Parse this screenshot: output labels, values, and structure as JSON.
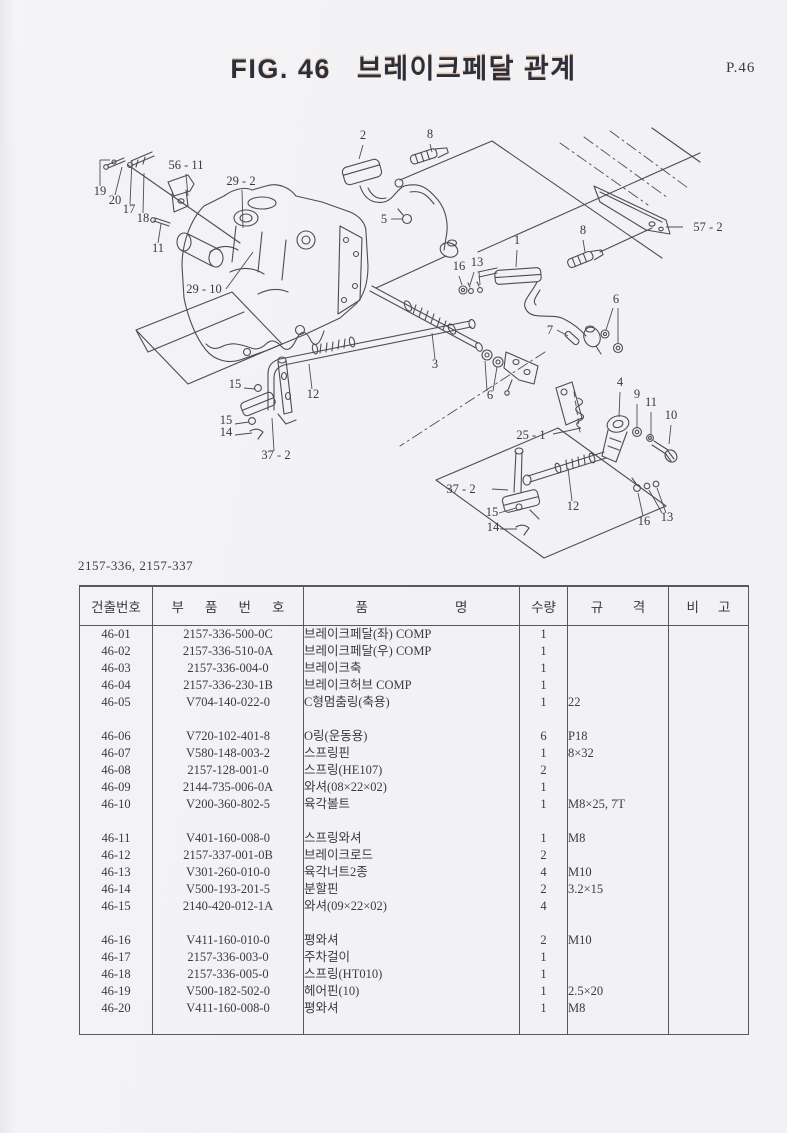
{
  "header": {
    "fig_label": "FIG. 46",
    "title": "브레이크페달 관계",
    "page_label": "P.46"
  },
  "models_label": "2157-336, 2157-337",
  "diagram": {
    "callouts": [
      {
        "label": "19",
        "x": 100,
        "y": 195,
        "leaders": [
          [
            100,
            186,
            100,
            160
          ],
          [
            100,
            160,
            110,
            160
          ]
        ]
      },
      {
        "label": "20",
        "x": 115,
        "y": 204,
        "leaders": [
          [
            115,
            195,
            122,
            167
          ]
        ]
      },
      {
        "label": "17",
        "x": 129,
        "y": 213,
        "leaders": [
          [
            130,
            204,
            132,
            160
          ]
        ]
      },
      {
        "label": "18",
        "x": 143,
        "y": 222,
        "leaders": [
          [
            143,
            213,
            144,
            173
          ]
        ]
      },
      {
        "label": "56 - 11",
        "x": 186,
        "y": 169,
        "leaders": [
          [
            186,
            174,
            188,
            196
          ]
        ]
      },
      {
        "label": "11",
        "x": 158,
        "y": 252,
        "leaders": [
          [
            158,
            243,
            161,
            224
          ]
        ]
      },
      {
        "label": "29 - 2",
        "x": 241,
        "y": 185,
        "leaders": [
          [
            242,
            190,
            243,
            228
          ]
        ]
      },
      {
        "label": "29 - 10",
        "x": 204,
        "y": 293,
        "leaders": [
          [
            226,
            289,
            253,
            252
          ]
        ]
      },
      {
        "label": "2",
        "x": 363,
        "y": 139,
        "leaders": [
          [
            363,
            145,
            359,
            159
          ]
        ]
      },
      {
        "label": "8",
        "x": 430,
        "y": 138,
        "leaders": [
          [
            430,
            144,
            432,
            152
          ]
        ]
      },
      {
        "label": "5",
        "x": 384,
        "y": 223,
        "leaders": [
          [
            391,
            219,
            402,
            219
          ]
        ]
      },
      {
        "label": "8",
        "x": 583,
        "y": 234,
        "leaders": [
          [
            583,
            240,
            585,
            252
          ]
        ]
      },
      {
        "label": "1",
        "x": 517,
        "y": 244,
        "leaders": [
          [
            517,
            250,
            516,
            267
          ]
        ]
      },
      {
        "label": "16",
        "x": 459,
        "y": 270,
        "leaders": [
          [
            459,
            276,
            462,
            285
          ]
        ]
      },
      {
        "label": "13",
        "x": 477,
        "y": 266,
        "leaders": [
          [
            474,
            272,
            470,
            285
          ],
          [
            479,
            272,
            480,
            285
          ]
        ]
      },
      {
        "label": "57 - 2",
        "x": 708,
        "y": 231,
        "leaders": [
          [
            683,
            227,
            666,
            227
          ]
        ]
      },
      {
        "label": "7",
        "x": 550,
        "y": 334,
        "leaders": [
          [
            557,
            330,
            568,
            336
          ]
        ]
      },
      {
        "label": "6",
        "x": 616,
        "y": 303,
        "leaders": [
          [
            613,
            308,
            606,
            330
          ],
          [
            618,
            308,
            618,
            343
          ]
        ]
      },
      {
        "label": "3",
        "x": 435,
        "y": 368,
        "leaders": [
          [
            435,
            359,
            432,
            333
          ]
        ]
      },
      {
        "label": "6",
        "x": 490,
        "y": 399,
        "leaders": [
          [
            487,
            391,
            485,
            361
          ],
          [
            493,
            391,
            497,
            367
          ]
        ]
      },
      {
        "label": "12",
        "x": 313,
        "y": 398,
        "leaders": [
          [
            312,
            389,
            309,
            364
          ]
        ]
      },
      {
        "label": "15",
        "x": 235,
        "y": 388,
        "leaders": [
          [
            244,
            388,
            255,
            389
          ]
        ]
      },
      {
        "label": "15",
        "x": 226,
        "y": 424,
        "leaders": [
          [
            235,
            424,
            249,
            422
          ]
        ]
      },
      {
        "label": "14",
        "x": 226,
        "y": 436,
        "leaders": [
          [
            235,
            435,
            252,
            433
          ]
        ]
      },
      {
        "label": "37 - 2",
        "x": 276,
        "y": 459,
        "leaders": [
          [
            274,
            451,
            272,
            418
          ]
        ]
      },
      {
        "label": "25 - 1",
        "x": 531,
        "y": 439,
        "leaders": [
          [
            553,
            434,
            581,
            428
          ]
        ]
      },
      {
        "label": "4",
        "x": 620,
        "y": 386,
        "leaders": [
          [
            620,
            392,
            619,
            417
          ]
        ]
      },
      {
        "label": "9",
        "x": 637,
        "y": 398,
        "leaders": [
          [
            637,
            404,
            637,
            428
          ]
        ]
      },
      {
        "label": "11",
        "x": 651,
        "y": 406,
        "leaders": [
          [
            651,
            412,
            651,
            435
          ]
        ]
      },
      {
        "label": "10",
        "x": 671,
        "y": 419,
        "leaders": [
          [
            671,
            425,
            669,
            444
          ]
        ]
      },
      {
        "label": "37 - 2",
        "x": 461,
        "y": 493,
        "leaders": [
          [
            492,
            489,
            508,
            490
          ]
        ]
      },
      {
        "label": "15",
        "x": 492,
        "y": 516,
        "leaders": [
          [
            499,
            513,
            516,
            508
          ]
        ]
      },
      {
        "label": "14",
        "x": 493,
        "y": 531,
        "leaders": [
          [
            500,
            529,
            517,
            529
          ]
        ]
      },
      {
        "label": "12",
        "x": 573,
        "y": 510,
        "leaders": [
          [
            572,
            501,
            568,
            468
          ]
        ]
      },
      {
        "label": "16",
        "x": 644,
        "y": 525,
        "leaders": [
          [
            643,
            516,
            638,
            493
          ]
        ]
      },
      {
        "label": "13",
        "x": 667,
        "y": 521,
        "leaders": [
          [
            662,
            513,
            649,
            490
          ],
          [
            666,
            513,
            657,
            488
          ]
        ]
      }
    ]
  },
  "table": {
    "headers": [
      [
        "건출번호"
      ],
      [
        "부",
        "품",
        "번",
        "호"
      ],
      [
        "품",
        "명"
      ],
      [
        "수량"
      ],
      [
        "규",
        "격"
      ],
      [
        "비",
        "고"
      ]
    ],
    "groups": [
      [
        [
          "46-01",
          "2157-336-500-0C",
          "브레이크페달(좌) COMP",
          "1",
          "",
          ""
        ],
        [
          "46-02",
          "2157-336-510-0A",
          "브레이크페달(우) COMP",
          "1",
          "",
          ""
        ],
        [
          "46-03",
          "2157-336-004-0",
          "브레이크축",
          "1",
          "",
          ""
        ],
        [
          "46-04",
          "2157-336-230-1B",
          "브레이크허브 COMP",
          "1",
          "",
          ""
        ],
        [
          "46-05",
          "V704-140-022-0",
          "C형멈춤링(축용)",
          "1",
          "22",
          ""
        ]
      ],
      [
        [
          "46-06",
          "V720-102-401-8",
          "O링(운동용)",
          "6",
          "P18",
          ""
        ],
        [
          "46-07",
          "V580-148-003-2",
          "스프링핀",
          "1",
          "8×32",
          ""
        ],
        [
          "46-08",
          "2157-128-001-0",
          "스프링(HE107)",
          "2",
          "",
          ""
        ],
        [
          "46-09",
          "2144-735-006-0A",
          "와셔(08×22×02)",
          "1",
          "",
          ""
        ],
        [
          "46-10",
          "V200-360-802-5",
          "육각볼트",
          "1",
          "M8×25, 7T",
          ""
        ]
      ],
      [
        [
          "46-11",
          "V401-160-008-0",
          "스프링와셔",
          "1",
          "M8",
          ""
        ],
        [
          "46-12",
          "2157-337-001-0B",
          "브레이크로드",
          "2",
          "",
          ""
        ],
        [
          "46-13",
          "V301-260-010-0",
          "육각너트2종",
          "4",
          "M10",
          ""
        ],
        [
          "46-14",
          "V500-193-201-5",
          "분할핀",
          "2",
          "3.2×15",
          ""
        ],
        [
          "46-15",
          "2140-420-012-1A",
          "와셔(09×22×02)",
          "4",
          "",
          ""
        ]
      ],
      [
        [
          "46-16",
          "V411-160-010-0",
          "평와셔",
          "2",
          "M10",
          ""
        ],
        [
          "46-17",
          "2157-336-003-0",
          "주차걸이",
          "1",
          "",
          ""
        ],
        [
          "46-18",
          "2157-336-005-0",
          "스프링(HT010)",
          "1",
          "",
          ""
        ],
        [
          "46-19",
          "V500-182-502-0",
          "헤어핀(10)",
          "1",
          "2.5×20",
          ""
        ],
        [
          "46-20",
          "V411-160-008-0",
          "평와셔",
          "1",
          "M8",
          ""
        ]
      ]
    ]
  }
}
